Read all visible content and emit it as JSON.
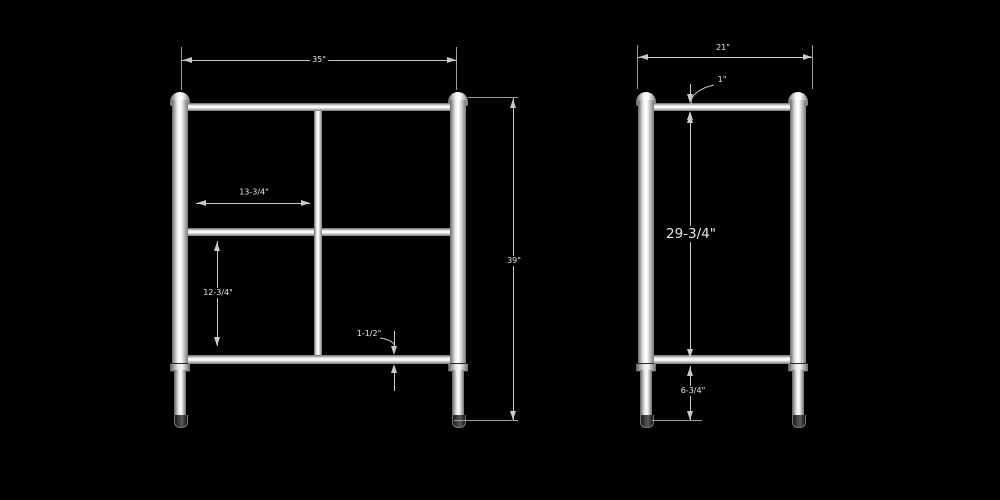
{
  "colors": {
    "background": "#000000",
    "line": "#c9c9c9",
    "tube_fill": "#f2f2f2",
    "text": "#e6e6e6"
  },
  "front_view": {
    "overall_width": "35\"",
    "overall_height": "39\"",
    "shelf_span": "13-3/4\"",
    "lower_opening": "12-3/4\"",
    "rail_thickness": "1-1/2\""
  },
  "side_view": {
    "overall_depth": "21\"",
    "top_rail_height": "1\"",
    "panel_height": "29-3/4\"",
    "foot_height": "6-3/4\""
  }
}
